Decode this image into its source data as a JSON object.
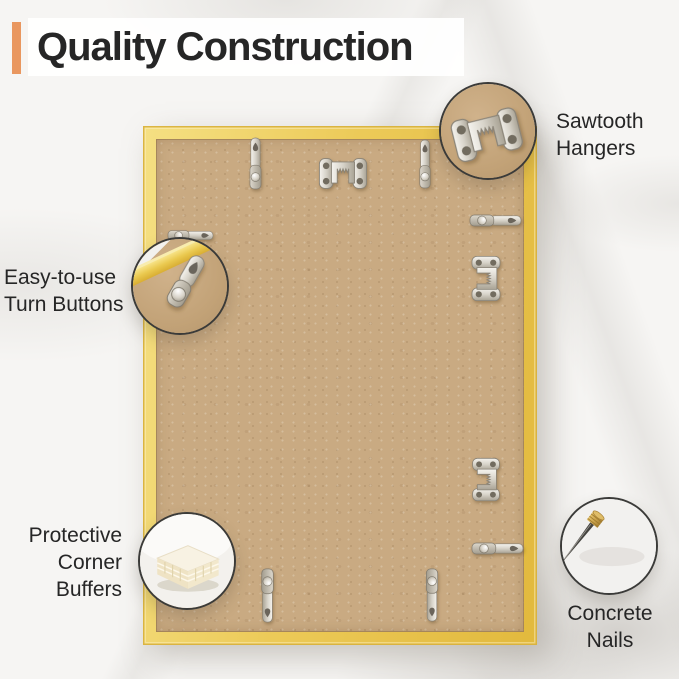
{
  "title": "Quality Construction",
  "colors": {
    "accent_orange": "#E9975F",
    "frame_gold": "#E9C54F",
    "backing_tan": "#C9AA82",
    "text_dark": "#262626"
  },
  "callouts": {
    "sawtooth_hangers": {
      "lines": [
        "Sawtooth",
        "Hangers"
      ],
      "icon": "sawtooth-hanger-icon"
    },
    "turn_buttons": {
      "lines": [
        "Easy-to-use",
        "Turn Buttons"
      ],
      "icon": "turn-button-icon"
    },
    "corner_buffers": {
      "lines": [
        "Protective",
        "Corner",
        "Buffers"
      ],
      "icon": "corner-buffer-icon"
    },
    "concrete_nails": {
      "lines": [
        "Concrete",
        "Nails"
      ],
      "icon": "concrete-nail-icon"
    }
  },
  "frame_hardware": {
    "sawtooth_hangers_visible": 3,
    "turn_buttons_visible": 7
  }
}
